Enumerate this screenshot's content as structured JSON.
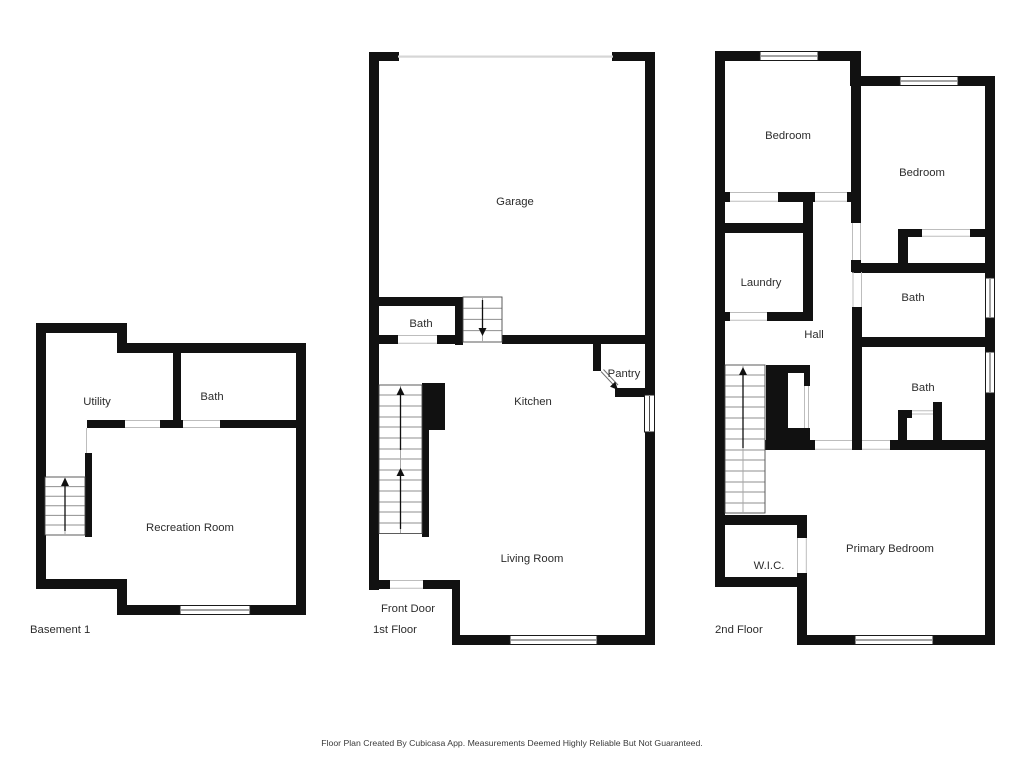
{
  "title": "Floor Plan",
  "colors": {
    "wall": "#111111",
    "background": "#ffffff",
    "label_text": "#2c2c2c",
    "stair_step": "#8f8f8f",
    "door_threshold": "#bdbdbd"
  },
  "floors": {
    "basement": {
      "label": "Basement 1",
      "rooms": {
        "utility": "Utility",
        "bath": "Bath",
        "recreation": "Recreation Room"
      }
    },
    "first": {
      "label": "1st Floor",
      "front_door": "Front Door",
      "rooms": {
        "garage": "Garage",
        "bath": "Bath",
        "kitchen": "Kitchen",
        "pantry": "Pantry",
        "living": "Living Room"
      }
    },
    "second": {
      "label": "2nd Floor",
      "rooms": {
        "bedroom_left": "Bedroom",
        "bedroom_right": "Bedroom",
        "laundry": "Laundry",
        "hall": "Hall",
        "bath_upper": "Bath",
        "bath_lower": "Bath",
        "wic": "W.I.C.",
        "primary": "Primary Bedroom"
      }
    }
  },
  "footer": {
    "disclaimer": "Floor Plan Created By Cubicasa App. Measurements Deemed Highly Reliable But Not Guaranteed."
  }
}
